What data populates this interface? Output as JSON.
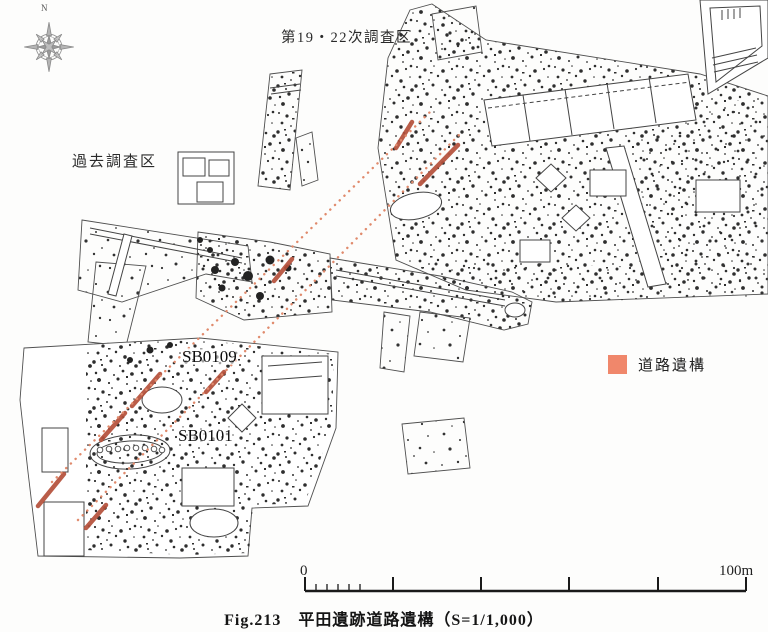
{
  "figure": {
    "caption": "Fig.213　平田遺跡道路遺構（S=1/1,000）"
  },
  "map": {
    "compass_label": "N",
    "area_labels": {
      "survey_19_22": "第19・22次調査区",
      "past_survey": "過去調査区"
    },
    "features": {
      "sb0109": "SB0109",
      "sb0101": "SB0101"
    },
    "legend": {
      "road_label": "道路遺構",
      "road_color": "#F0876B"
    },
    "scale_bar": {
      "start": "0",
      "end": "100m"
    }
  },
  "colors": {
    "highlight": "#F5EBAA",
    "road_segment": "#B5503A",
    "alignment_line": "#E08A6C"
  }
}
